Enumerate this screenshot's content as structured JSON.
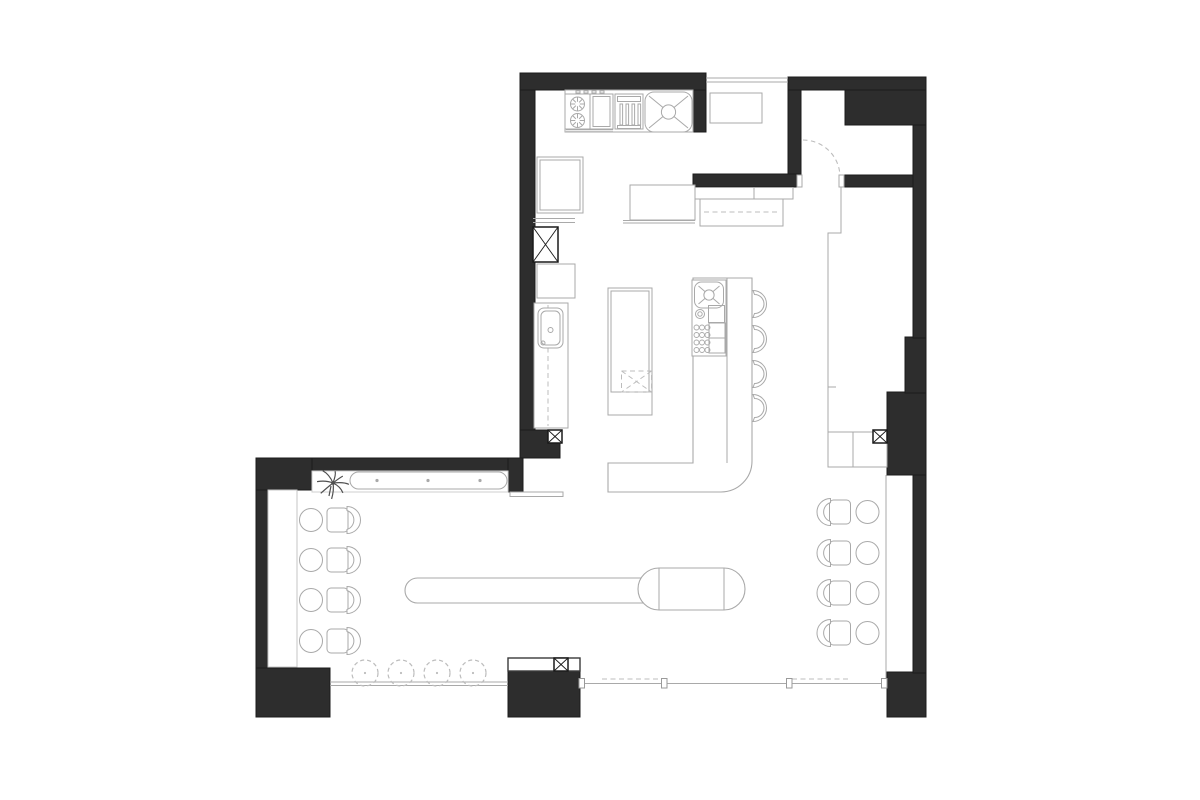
{
  "meta": {
    "title": "Restaurant floor plan drawing",
    "canvas": {
      "width": 1200,
      "height": 800
    },
    "style": "black-and-white architectural plan, no text labels"
  },
  "palette": {
    "bg": "#ffffff",
    "wall": "#2d2d2d",
    "wall_stroke": "#1c1c1c",
    "line": "#a9a9a9",
    "line_dark": "#3a3a3a",
    "line_light": "#c9c9c9",
    "dash": "#bcbcbc",
    "ink": "#1a1a1a",
    "plant": "#4f4f4f"
  },
  "inventory": {
    "areas": [
      "kitchen",
      "entry-vestibule",
      "bar",
      "dining-left",
      "dining-right",
      "window-bar",
      "bench-niche",
      "closet"
    ],
    "bar_stools": 4,
    "round_tables": 8,
    "chairs": 8,
    "window_stools": 4,
    "structural_columns_marked": 4,
    "range_burners": 2,
    "sinks": 3,
    "plants": 1,
    "door_swings": 1
  },
  "elements": [
    {
      "name": "wall-top-kitchen",
      "kind": "wall",
      "r": [
        520,
        73,
        186,
        17
      ]
    },
    {
      "name": "wall-pier-right-of-sink",
      "kind": "wall",
      "r": [
        692,
        90,
        14,
        42
      ]
    },
    {
      "name": "wall-left-kitchen",
      "kind": "wall",
      "r": [
        520,
        90,
        15,
        345
      ]
    },
    {
      "name": "wall-junction-block",
      "kind": "wall",
      "r": [
        520,
        430,
        40,
        28
      ]
    },
    {
      "name": "wall-bench-band",
      "kind": "wall",
      "r": [
        256,
        458,
        267,
        13
      ]
    },
    {
      "name": "wall-bench-left",
      "kind": "wall",
      "r": [
        256,
        458,
        56,
        32
      ]
    },
    {
      "name": "wall-bench-right",
      "kind": "wall",
      "r": [
        508,
        458,
        15,
        34
      ]
    },
    {
      "name": "wall-dining-left",
      "kind": "wall",
      "r": [
        256,
        490,
        12,
        178
      ]
    },
    {
      "name": "wall-corner-bottom-left",
      "kind": "wall",
      "r": [
        256,
        668,
        74,
        49
      ]
    },
    {
      "name": "wall-pier-bottom",
      "kind": "wall",
      "r": [
        508,
        671,
        72,
        46
      ]
    },
    {
      "name": "wall-corner-bottom-right",
      "kind": "wall",
      "r": [
        887,
        672,
        39,
        45
      ]
    },
    {
      "name": "wall-right-lower",
      "kind": "wall",
      "r": [
        913,
        475,
        13,
        198
      ]
    },
    {
      "name": "wall-right-mass",
      "kind": "wall",
      "r": [
        887,
        392,
        39,
        83
      ]
    },
    {
      "name": "wall-right-step",
      "kind": "wall",
      "r": [
        905,
        337,
        21,
        56
      ]
    },
    {
      "name": "wall-right-upper",
      "kind": "wall",
      "r": [
        913,
        125,
        13,
        213
      ]
    },
    {
      "name": "wall-top-right-band",
      "kind": "wall",
      "r": [
        788,
        77,
        138,
        13
      ]
    },
    {
      "name": "wall-entry-block",
      "kind": "wall",
      "r": [
        845,
        90,
        81,
        35
      ]
    },
    {
      "name": "wall-entry-left",
      "kind": "wall",
      "r": [
        788,
        90,
        13,
        85
      ]
    },
    {
      "name": "wall-entry-bottom-left",
      "kind": "wall",
      "r": [
        693,
        174,
        108,
        13
      ]
    },
    {
      "name": "wall-entry-bottom-right",
      "kind": "wall",
      "r": [
        843,
        175,
        70,
        12
      ]
    },
    {
      "name": "pass-window-line",
      "kind": "line",
      "r": [
        706,
        78,
        788,
        78
      ]
    },
    {
      "name": "pass-window-line",
      "kind": "line",
      "r": [
        706,
        82,
        788,
        82
      ]
    },
    {
      "name": "entry-side-table",
      "kind": "rect",
      "r": [
        710,
        93,
        52,
        30
      ]
    },
    {
      "name": "door-swing-arc",
      "kind": "dpath",
      "d": "M803,140 A37,37 0 0 1 840,177"
    },
    {
      "name": "door-jamb",
      "kind": "rect",
      "r": [
        797,
        175,
        5,
        12
      ]
    },
    {
      "name": "door-jamb",
      "kind": "rect",
      "r": [
        839,
        175,
        5,
        12
      ]
    },
    {
      "name": "entry-counter",
      "kind": "rect",
      "r": [
        693,
        187.5,
        100,
        11.5
      ]
    },
    {
      "name": "entry-counter-divider",
      "kind": "line",
      "r": [
        754,
        188,
        754,
        199
      ]
    },
    {
      "name": "entry-cabinet",
      "kind": "rect",
      "r": [
        700,
        199,
        83,
        27
      ]
    },
    {
      "name": "entry-cabinet-dash",
      "kind": "dline",
      "r": [
        704,
        212,
        779,
        212
      ]
    },
    {
      "name": "entry-boundary-line",
      "kind": "poly",
      "pts": "841,187 841,233 828,233 828,467"
    },
    {
      "name": "entry-boundary-tick",
      "kind": "line",
      "r": [
        828,
        387,
        836,
        387
      ]
    },
    {
      "name": "appliance-strip",
      "kind": "rect",
      "r": [
        565,
        90,
        128,
        42
      ]
    },
    {
      "name": "range-unit",
      "kind": "rect",
      "r": [
        565,
        94,
        25,
        35
      ]
    },
    {
      "name": "range-burner",
      "kind": "burner",
      "c": [
        577.5,
        104,
        7
      ]
    },
    {
      "name": "range-burner",
      "kind": "burner",
      "c": [
        577.5,
        120.5,
        7
      ]
    },
    {
      "name": "range-knob",
      "kind": "rect",
      "r": [
        576,
        90.8,
        4,
        2.2
      ]
    },
    {
      "name": "range-knob",
      "kind": "rect",
      "r": [
        584,
        90.8,
        4,
        2.2
      ]
    },
    {
      "name": "range-knob",
      "kind": "rect",
      "r": [
        592,
        90.8,
        4,
        2.2
      ]
    },
    {
      "name": "range-knob",
      "kind": "rect",
      "r": [
        600,
        90.8,
        4,
        2.2
      ]
    },
    {
      "name": "oven-unit",
      "kind": "rect",
      "r": [
        590,
        94,
        23,
        35
      ]
    },
    {
      "name": "oven-door",
      "kind": "rect",
      "r": [
        593,
        96.5,
        17,
        30
      ],
      "fill": "none"
    },
    {
      "name": "range-shelf-line",
      "kind": "line",
      "r": [
        566,
        129.7,
        613,
        129.7
      ]
    },
    {
      "name": "range-shelf-line",
      "kind": "line",
      "r": [
        566,
        131.7,
        613,
        131.7
      ]
    },
    {
      "name": "grill-unit",
      "kind": "rect",
      "r": [
        615,
        94,
        28,
        35
      ]
    },
    {
      "name": "grill-top",
      "kind": "rect",
      "r": [
        617.5,
        96.5,
        23,
        5
      ],
      "fill": "none"
    },
    {
      "name": "grill-bar",
      "kind": "rect",
      "r": [
        620,
        104,
        2.6,
        21
      ],
      "fill": "none"
    },
    {
      "name": "grill-bar",
      "kind": "rect",
      "r": [
        626,
        104,
        2.6,
        21
      ],
      "fill": "none"
    },
    {
      "name": "grill-bar",
      "kind": "rect",
      "r": [
        632,
        104,
        2.6,
        21
      ],
      "fill": "none"
    },
    {
      "name": "grill-bar",
      "kind": "rect",
      "r": [
        638,
        104,
        2.6,
        21
      ],
      "fill": "none"
    },
    {
      "name": "grill-base",
      "kind": "rect",
      "r": [
        617.5,
        125.5,
        23,
        3
      ],
      "fill": "none"
    },
    {
      "name": "kitchen-sink",
      "kind": "sinkx",
      "r": [
        645,
        92,
        47,
        40,
        9
      ]
    },
    {
      "name": "refrigerator",
      "kind": "rect",
      "r": [
        537,
        157,
        46,
        56
      ]
    },
    {
      "name": "refrigerator-inner",
      "kind": "rect",
      "r": [
        540,
        160,
        40,
        50
      ],
      "fill": "none"
    },
    {
      "name": "counter-shelf-line",
      "kind": "line",
      "r": [
        533,
        218.5,
        575,
        218.5
      ]
    },
    {
      "name": "counter-shelf-line",
      "kind": "line",
      "r": [
        533,
        222.5,
        575,
        222.5
      ]
    },
    {
      "name": "column-x-marker",
      "kind": "xbox",
      "r": [
        533,
        227,
        25,
        35
      ]
    },
    {
      "name": "kitchen-cabinet",
      "kind": "rect",
      "r": [
        537,
        264,
        38,
        34
      ]
    },
    {
      "name": "tall-counter",
      "kind": "rect",
      "r": [
        534,
        303,
        34,
        125
      ]
    },
    {
      "name": "tall-counter-dash",
      "kind": "dline",
      "r": [
        548,
        305,
        548,
        426
      ]
    },
    {
      "name": "wash-basin",
      "kind": "rect",
      "r": [
        538,
        308,
        25,
        40
      ],
      "rx": 6
    },
    {
      "name": "wash-basin-inner",
      "kind": "rect",
      "r": [
        541,
        311,
        19,
        34
      ],
      "rx": 5,
      "fill": "none"
    },
    {
      "name": "wash-basin-faucet",
      "kind": "circle",
      "c": [
        550.5,
        330,
        2.5
      ],
      "fill": "none"
    },
    {
      "name": "wash-basin-drain",
      "kind": "circle",
      "c": [
        543,
        343,
        2
      ],
      "fill": "none"
    },
    {
      "name": "column-x-marker",
      "kind": "xbox",
      "r": [
        548,
        430,
        14,
        13
      ]
    },
    {
      "name": "prep-counter",
      "kind": "rect",
      "r": [
        630,
        185,
        65,
        35
      ]
    },
    {
      "name": "prep-counter-edge",
      "kind": "line",
      "r": [
        623,
        220.5,
        695,
        220.5
      ]
    },
    {
      "name": "prep-counter-edge",
      "kind": "line",
      "r": [
        623,
        223,
        695,
        223
      ]
    },
    {
      "name": "kitchen-island",
      "kind": "rect",
      "r": [
        608,
        288,
        44,
        127
      ]
    },
    {
      "name": "kitchen-island-top",
      "kind": "rect",
      "r": [
        611,
        291,
        38,
        101
      ],
      "fill": "none"
    },
    {
      "name": "undercounter-dishwasher",
      "kind": "drect",
      "r": [
        621.5,
        371,
        30,
        21
      ],
      "cross": true
    },
    {
      "name": "bar-counter",
      "kind": "path",
      "d": "M608,463 H693 V278 H752 V461 A31,31 0 0 1 721,492 H608 Z"
    },
    {
      "name": "bar-counter-inner-line",
      "kind": "line",
      "r": [
        727,
        278,
        727,
        463
      ]
    },
    {
      "name": "bar-equipment-box",
      "kind": "rect",
      "r": [
        692,
        280,
        34,
        76
      ]
    },
    {
      "name": "bar-sink",
      "kind": "sinkx",
      "r": [
        694.5,
        282,
        29,
        26,
        7
      ]
    },
    {
      "name": "bar-burner-ring",
      "kind": "circle",
      "c": [
        700,
        314,
        4.5
      ],
      "fill": "none"
    },
    {
      "name": "bar-burner-ring",
      "kind": "circle",
      "c": [
        700,
        314,
        2.2
      ],
      "fill": "none"
    },
    {
      "name": "bar-small-box",
      "kind": "rect",
      "r": [
        708.5,
        305.5,
        16,
        17
      ],
      "fill": "none"
    },
    {
      "name": "glass-rack-dots",
      "kind": "dots",
      "g": [
        696.5,
        327.5,
        3,
        4,
        5.5,
        7.5,
        2.5
      ]
    },
    {
      "name": "bar-shelf",
      "kind": "rect",
      "r": [
        709,
        323,
        16,
        15
      ],
      "fill": "none"
    },
    {
      "name": "bar-shelf",
      "kind": "rect",
      "r": [
        709,
        338,
        16,
        15
      ],
      "fill": "none"
    },
    {
      "name": "bar-stool",
      "kind": "stool",
      "c": [
        753,
        304
      ]
    },
    {
      "name": "bar-stool",
      "kind": "stool",
      "c": [
        753,
        339
      ]
    },
    {
      "name": "bar-stool",
      "kind": "stool",
      "c": [
        753,
        374
      ]
    },
    {
      "name": "bar-stool",
      "kind": "stool",
      "c": [
        753,
        408
      ]
    },
    {
      "name": "communal-table",
      "kind": "path",
      "d": "M417.5,578 H645 V603 H417.5 A12.5,12.5 0 0 1 417.5,578 Z"
    },
    {
      "name": "oval-table",
      "kind": "path",
      "d": "M659,568 H724 A21,21 0 0 1 724,610 H659 A21,21 0 0 1 659,568 Z"
    },
    {
      "name": "oval-table-chord",
      "kind": "line",
      "r": [
        659,
        568,
        659,
        610
      ]
    },
    {
      "name": "oval-table-chord",
      "kind": "line",
      "r": [
        724,
        568,
        724,
        610
      ]
    },
    {
      "name": "bench-niche",
      "kind": "rect",
      "r": [
        312,
        471,
        196,
        21
      ],
      "stroke": "#cfcfcf"
    },
    {
      "name": "wall-bench-seat",
      "kind": "rect",
      "r": [
        350,
        472,
        157,
        17
      ],
      "rx": 8.5
    },
    {
      "name": "bench-button",
      "kind": "dot",
      "c": [
        377,
        480.5,
        1.6
      ]
    },
    {
      "name": "bench-button",
      "kind": "dot",
      "c": [
        428,
        480.5,
        1.6
      ]
    },
    {
      "name": "bench-button",
      "kind": "dot",
      "c": [
        480,
        480.5,
        1.6
      ]
    },
    {
      "name": "potted-plant",
      "kind": "plant",
      "c": [
        333,
        483
      ]
    },
    {
      "name": "party-wall-strip",
      "kind": "rect",
      "r": [
        510,
        492,
        53,
        4.5
      ]
    },
    {
      "name": "window-ledge-left",
      "kind": "rect",
      "r": [
        268,
        490,
        29,
        177
      ],
      "stroke": "#c4c4c4"
    },
    {
      "name": "dining-table-round",
      "kind": "circle",
      "c": [
        311,
        520,
        11.5
      ]
    },
    {
      "name": "dining-table-round",
      "kind": "circle",
      "c": [
        311,
        560,
        11.5
      ]
    },
    {
      "name": "dining-table-round",
      "kind": "circle",
      "c": [
        311,
        600,
        11.5
      ]
    },
    {
      "name": "dining-table-round",
      "kind": "circle",
      "c": [
        311,
        641,
        11.5
      ]
    },
    {
      "name": "dining-chair",
      "kind": "chair",
      "c": [
        337.5,
        520
      ],
      "side": "R"
    },
    {
      "name": "dining-chair",
      "kind": "chair",
      "c": [
        337.5,
        560
      ],
      "side": "R"
    },
    {
      "name": "dining-chair",
      "kind": "chair",
      "c": [
        337.5,
        600
      ],
      "side": "R"
    },
    {
      "name": "dining-chair",
      "kind": "chair",
      "c": [
        337.5,
        641
      ],
      "side": "R"
    },
    {
      "name": "dining-right-edge-line",
      "kind": "line",
      "r": [
        886,
        475,
        886,
        683
      ]
    },
    {
      "name": "closet",
      "kind": "rect",
      "r": [
        828,
        432,
        59,
        35
      ]
    },
    {
      "name": "closet-divider",
      "kind": "line",
      "r": [
        853,
        432,
        853,
        467
      ]
    },
    {
      "name": "column-x-marker",
      "kind": "xbox",
      "r": [
        873,
        430,
        14,
        13
      ]
    },
    {
      "name": "dining-chair",
      "kind": "chair",
      "c": [
        840,
        512
      ],
      "side": "L"
    },
    {
      "name": "dining-chair",
      "kind": "chair",
      "c": [
        840,
        553
      ],
      "side": "L"
    },
    {
      "name": "dining-chair",
      "kind": "chair",
      "c": [
        840,
        593
      ],
      "side": "L"
    },
    {
      "name": "dining-chair",
      "kind": "chair",
      "c": [
        840,
        633
      ],
      "side": "L"
    },
    {
      "name": "dining-table-round",
      "kind": "circle",
      "c": [
        867.5,
        512,
        11.5
      ]
    },
    {
      "name": "dining-table-round",
      "kind": "circle",
      "c": [
        867.5,
        553,
        11.5
      ]
    },
    {
      "name": "dining-table-round",
      "kind": "circle",
      "c": [
        867.5,
        593,
        11.5
      ]
    },
    {
      "name": "dining-table-round",
      "kind": "circle",
      "c": [
        867.5,
        633,
        11.5
      ]
    },
    {
      "name": "storefront-window-line",
      "kind": "line",
      "r": [
        330,
        682,
        508,
        682
      ]
    },
    {
      "name": "storefront-window-line",
      "kind": "line",
      "r": [
        330,
        685.5,
        508,
        685.5
      ]
    },
    {
      "name": "window-stool",
      "kind": "dcircle",
      "c": [
        365,
        673,
        13
      ]
    },
    {
      "name": "window-stool",
      "kind": "dcircle",
      "c": [
        401,
        673,
        13
      ]
    },
    {
      "name": "window-stool",
      "kind": "dcircle",
      "c": [
        437,
        673,
        13
      ]
    },
    {
      "name": "window-stool",
      "kind": "dcircle",
      "c": [
        473,
        673,
        13
      ]
    },
    {
      "name": "pier-counter",
      "kind": "rect",
      "r": [
        508,
        658,
        72,
        13
      ],
      "stroke": "#3a3a3a",
      "sw": 1.4
    },
    {
      "name": "column-x-marker",
      "kind": "xbox",
      "r": [
        554,
        658,
        14,
        13
      ]
    },
    {
      "name": "storefront-window-line",
      "kind": "line",
      "r": [
        583,
        683.5,
        886,
        683.5
      ]
    },
    {
      "name": "storefront-dash-line",
      "kind": "dline",
      "r": [
        602,
        679,
        663,
        679
      ]
    },
    {
      "name": "storefront-dash-line",
      "kind": "dline",
      "r": [
        792,
        679,
        850,
        679
      ]
    },
    {
      "name": "window-jamb",
      "kind": "jamb",
      "r": [
        579,
        678.5
      ]
    },
    {
      "name": "window-jamb",
      "kind": "jamb",
      "r": [
        661.5,
        678.5
      ]
    },
    {
      "name": "window-jamb",
      "kind": "jamb",
      "r": [
        786.5,
        678.5
      ]
    },
    {
      "name": "window-jamb",
      "kind": "jamb",
      "r": [
        881.5,
        678.5
      ]
    }
  ]
}
